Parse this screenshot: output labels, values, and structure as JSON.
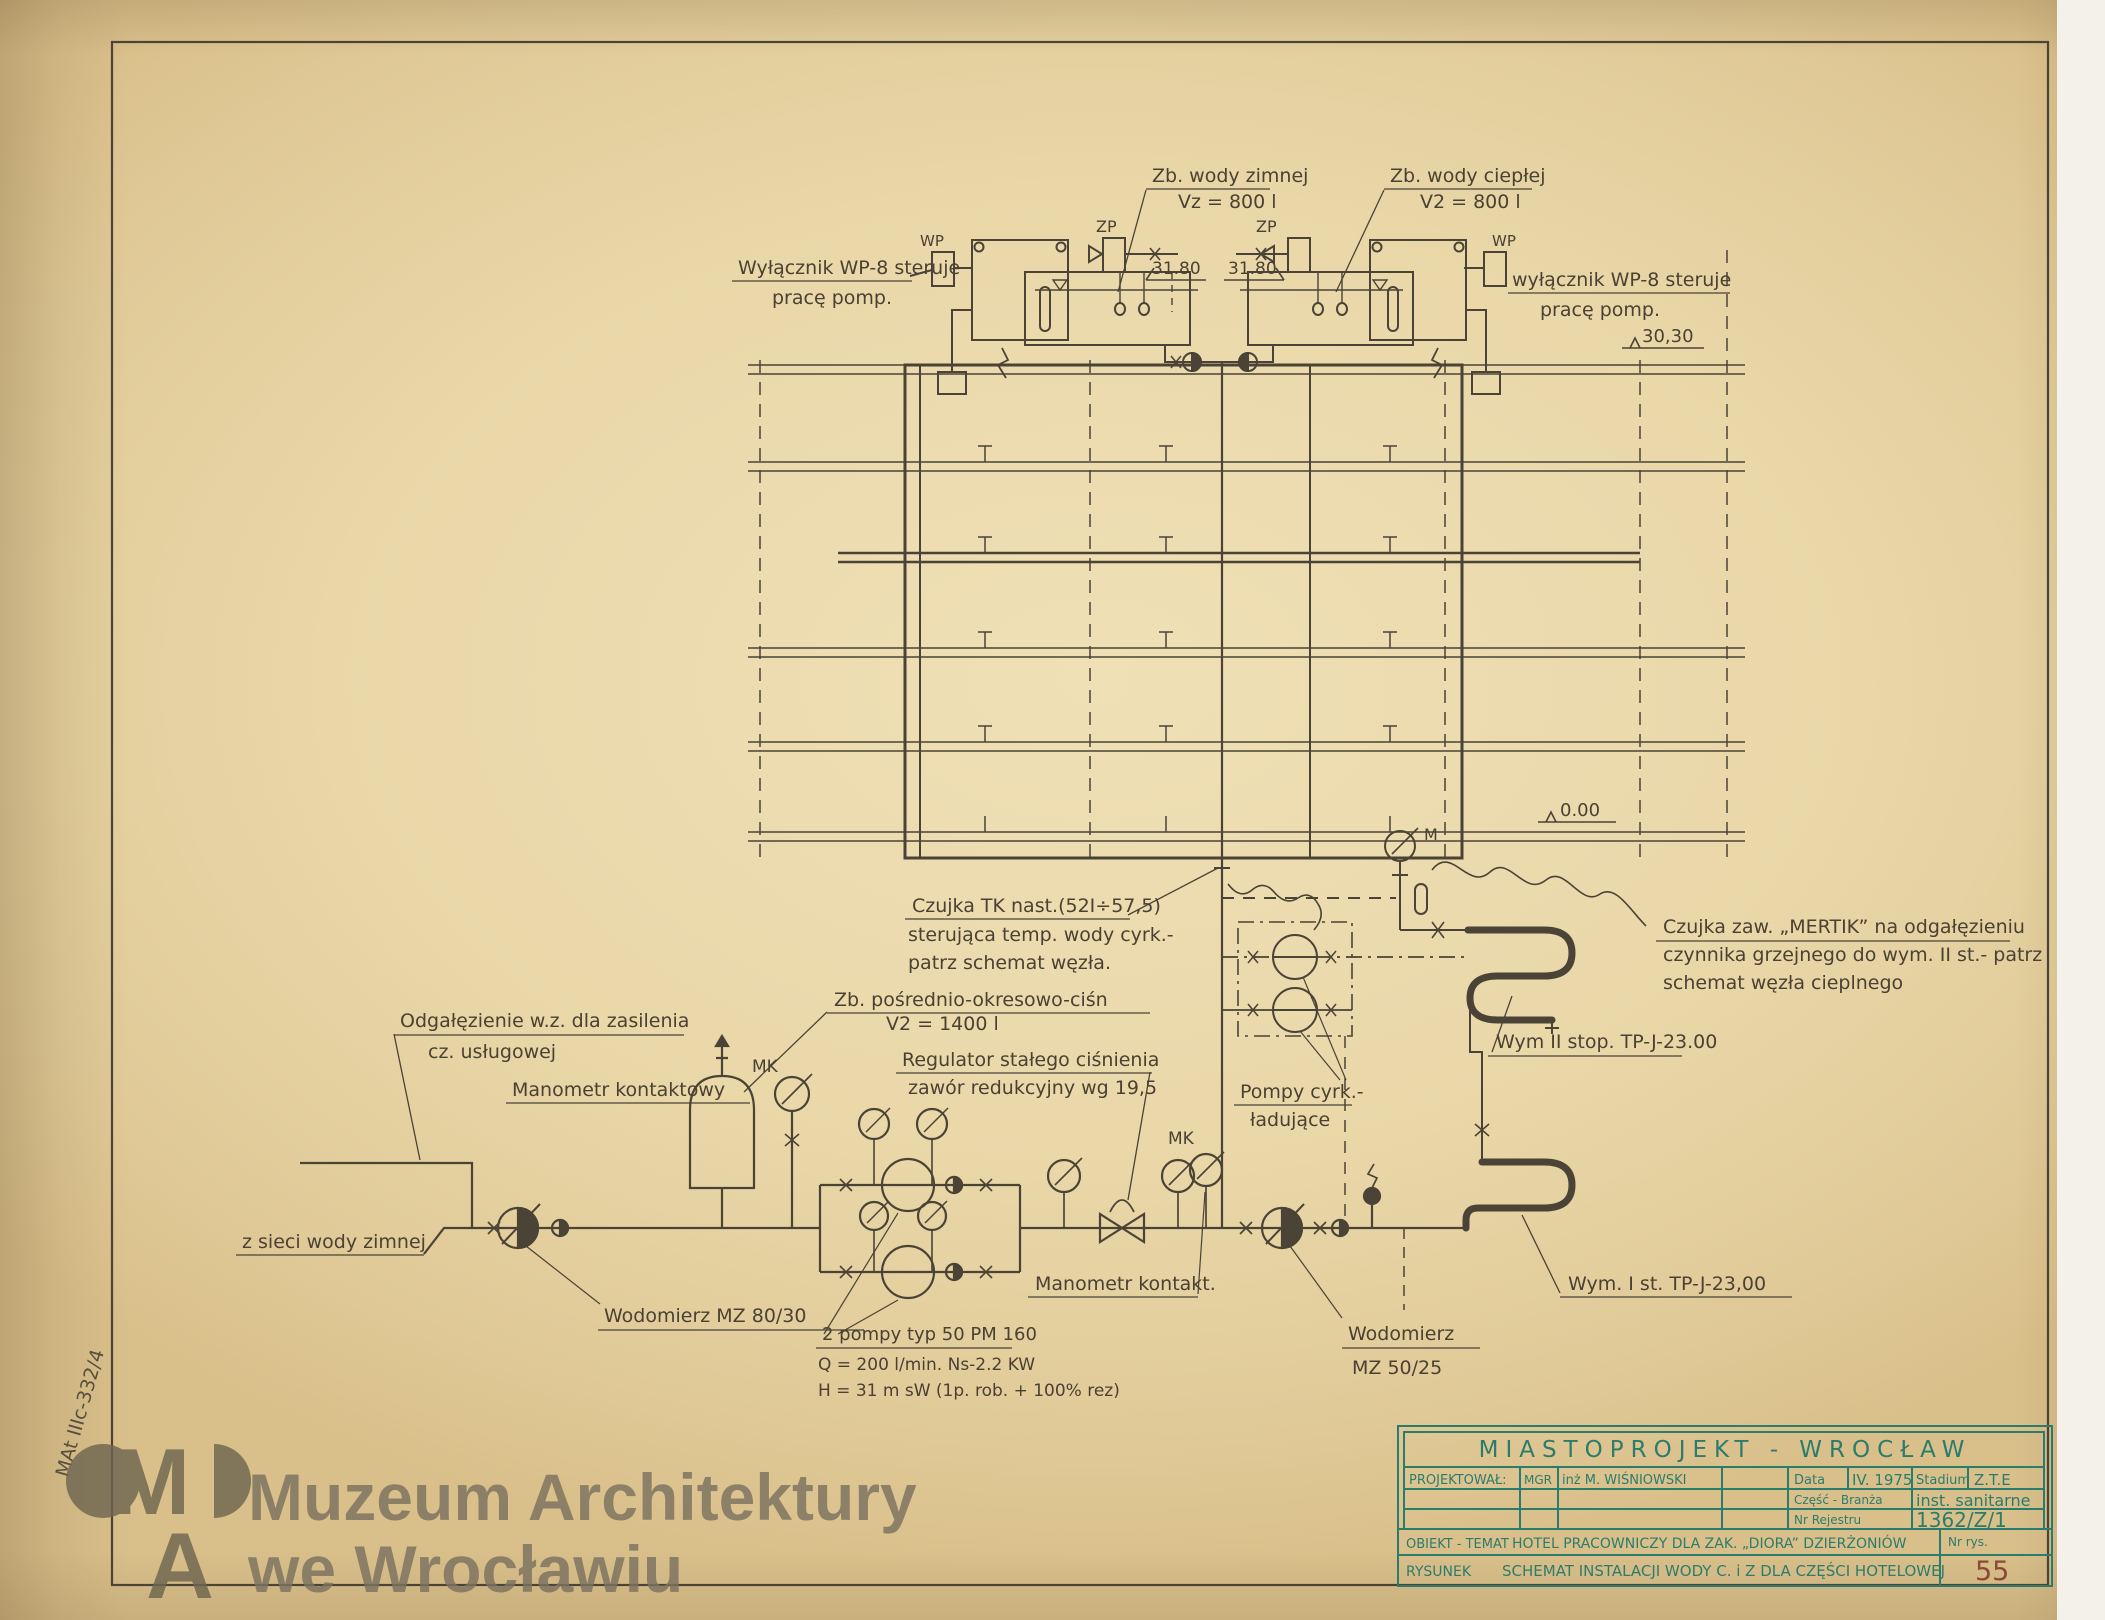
{
  "colors": {
    "ink": "#4a4336",
    "teal": "#2c7c6c",
    "red_number": "#8a4a38",
    "paper": "#e9d7a8",
    "watermark": "#6e6650"
  },
  "drawing": {
    "tanks": {
      "cold1": "Zb. wody zimnej",
      "cold2": "Vz = 800 l",
      "hot1": "Zb. wody ciepłej",
      "hot2": "V2 = 800 l",
      "zp": "ZP",
      "wp": "WP"
    },
    "switches": {
      "left1": "Wyłącznik WP-8 steruje",
      "left2": "pracę pomp.",
      "right1": "wyłącznik WP-8 steruje",
      "right2": "pracę pomp."
    },
    "elevations": {
      "tank_left": "31.80",
      "tank_right": "31.80",
      "roof": "30,30",
      "ground": "0.00"
    },
    "sensors": {
      "m": "M",
      "mk": "MK",
      "tk1": "Czujka TK nast.(52I÷57,5)",
      "tk2": "sterująca temp. wody cyrk.-",
      "tk3": "patrz schemat węzła.",
      "mertik1": "Czujka zaw. „MERTIK” na odgałęzieniu",
      "mertik2": "czynnika grzejnego do wym. II st.- patrz",
      "mertik3": "schemat węzła cieplnego"
    },
    "exchangers": {
      "wym2": "Wym II stop. TP-J-23.00",
      "wym1": "Wym. I st. TP-J-23,00"
    },
    "pumps": {
      "cyrk1": "Pompy cyrk.-",
      "cyrk2": "ładujące",
      "p1": "2 pompy typ 50 PM 160",
      "p2": "Q = 200 l/min. Ns-2.2 KW",
      "p3": "H = 31 m sW (1p. rob. + 100% rez)"
    },
    "lower": {
      "odgal1": "Odgałęzienie w.z. dla zasilenia",
      "odgal2": "cz. usługowej",
      "mank": "Manometr kontaktowy",
      "manks": "Manometr kontakt.",
      "zbp1": "Zb. pośrednio-okresowo-ciśn",
      "zbp2": "V2 = 1400 l",
      "reg1": "Regulator stałego ciśnienia",
      "reg2": "zawór redukcyjny wg 19,5",
      "zsieci": "z sieci wody zimnej",
      "wod1": "Wodomierz MZ 80/30",
      "wod2a": "Wodomierz",
      "wod2b": "MZ 50/25"
    }
  },
  "title_block": {
    "header": "MIASTOPROJEKT - WROCŁAW",
    "projektowal_label": "PROJEKTOWAŁ:",
    "projektowal_grade": "MGR",
    "projektowal_name": "inż M. WIŚNIOWSKI",
    "data_label": "Data",
    "data_value": "IV. 1975",
    "stadium_label": "Stadium",
    "stadium_value": "Z.T.E",
    "czesc_label": "Część - Branża",
    "czesc_value": "inst. sanitarne",
    "rejestr_label": "Nr Rejestru",
    "rejestr_value": "1362/Z/1",
    "obiekt_label": "OBIEKT - TEMAT",
    "obiekt_value": "HOTEL PRACOWNICZY DLA ZAK. „DIORA” DZIERŻONIÓW",
    "rysunek_label": "RYSUNEK",
    "rysunek_value": "SCHEMAT INSTALACJI WODY C. i Z DLA CZĘŚCI HOTELOWEJ",
    "nr_rys_label": "Nr rys.",
    "nr_rys_value": "55"
  },
  "watermark": {
    "line1": "Muzeum Architektury",
    "line2": "we Wrocławiu",
    "logo_m": "M",
    "logo_a": "A"
  },
  "archive_code": "MAt IIIc-332/4"
}
